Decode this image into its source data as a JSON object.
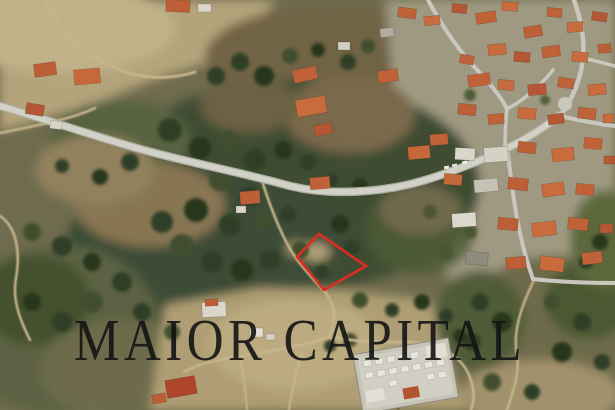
{
  "image": {
    "kind": "satellite-aerial-photograph",
    "subject": "Aerial satellite view of a hillside village with wooded terrain; a building plot is outlined in red",
    "width_px": 615,
    "height_px": 410
  },
  "watermark": {
    "text": "MAIOR CAPITAL",
    "color": "#141414",
    "opacity": 0.9
  },
  "plot_marker": {
    "shape": "quadrilateral outline",
    "points": "319,234 366,266 324,290 297,257",
    "stroke_color": "#dd2c22",
    "stroke_width": 2.6
  },
  "palette": {
    "vegetation_dark": "#3a4a2e",
    "scrub_olive": "#6f6243",
    "bare_earth_tan": "#b7a67c",
    "road_gray": "#d6d6cd",
    "dirt_track": "#cbb88d",
    "roof_terracotta": "#c46034",
    "building_white": "#e4e1d6",
    "marker_red": "#dd2c22"
  }
}
